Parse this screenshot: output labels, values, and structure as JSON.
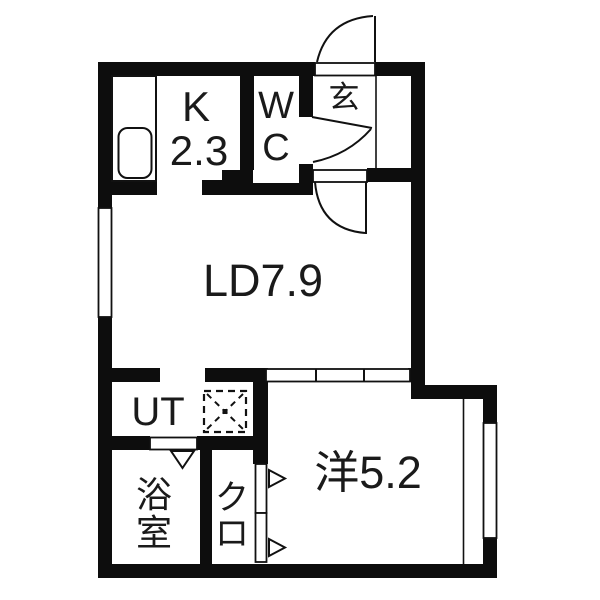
{
  "floorplan": {
    "type": "japanese-apartment-floor-plan",
    "colors": {
      "wall": "#0d0d0d",
      "background": "#ffffff",
      "line": "#111111",
      "text": "#1a1a1a"
    },
    "rooms": {
      "kitchen": {
        "label": "K",
        "area": "2.3",
        "full": "K 2.3"
      },
      "toilet": {
        "line1": "W",
        "line2": "C",
        "full": "WC"
      },
      "entrance": {
        "label": "玄",
        "full": "玄関"
      },
      "living_dining": {
        "label": "LD7.9"
      },
      "utility": {
        "label": "UT"
      },
      "bathroom": {
        "line1": "浴",
        "line2": "室",
        "full": "浴室"
      },
      "closet": {
        "line1": "ク",
        "line2": "ロ",
        "full": "クロ"
      },
      "western_room": {
        "label": "洋5.2"
      }
    },
    "symbols": {
      "sink": "kitchen-sink",
      "washer": "washing-machine-space",
      "swing_doors": [
        "front-door",
        "wc-door",
        "ld-door"
      ],
      "sliding_door": "ld-to-western-room-sliding-door",
      "folding_marks": [
        "bathroom-door-mark",
        "closet-door-marks"
      ]
    }
  }
}
